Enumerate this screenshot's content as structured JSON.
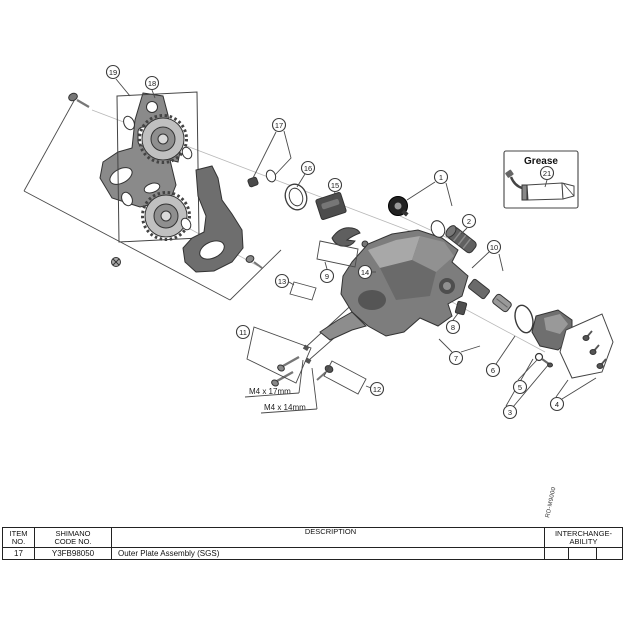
{
  "diagram": {
    "callouts": {
      "c1": "1",
      "c2": "2",
      "c3": "3",
      "c4": "4",
      "c5": "5",
      "c6": "6",
      "c7": "7",
      "c8": "8",
      "c9": "9",
      "c10": "10",
      "c11": "11",
      "c12": "12",
      "c13": "13",
      "c14": "14",
      "c15": "15",
      "c16": "16",
      "c17": "17",
      "c18": "18",
      "c19": "19",
      "c21": "21"
    },
    "grease_label": "Grease",
    "screw_labels": {
      "long": "M4 x 17mm",
      "short": "M4 x 14mm"
    },
    "model_code": "RD-M9000"
  },
  "table": {
    "headers": {
      "item_1": "ITEM",
      "item_2": "NO.",
      "code_1": "SHIMANO",
      "code_2": "CODE NO.",
      "desc": "DESCRIPTION",
      "inter_1": "INTERCHANGE-",
      "inter_2": "ABILITY"
    },
    "rows": [
      {
        "item": "17",
        "code": "Y3FB98050",
        "desc": "Outer Plate Assembly (SGS)",
        "inter": [
          "",
          "",
          ""
        ]
      }
    ]
  }
}
